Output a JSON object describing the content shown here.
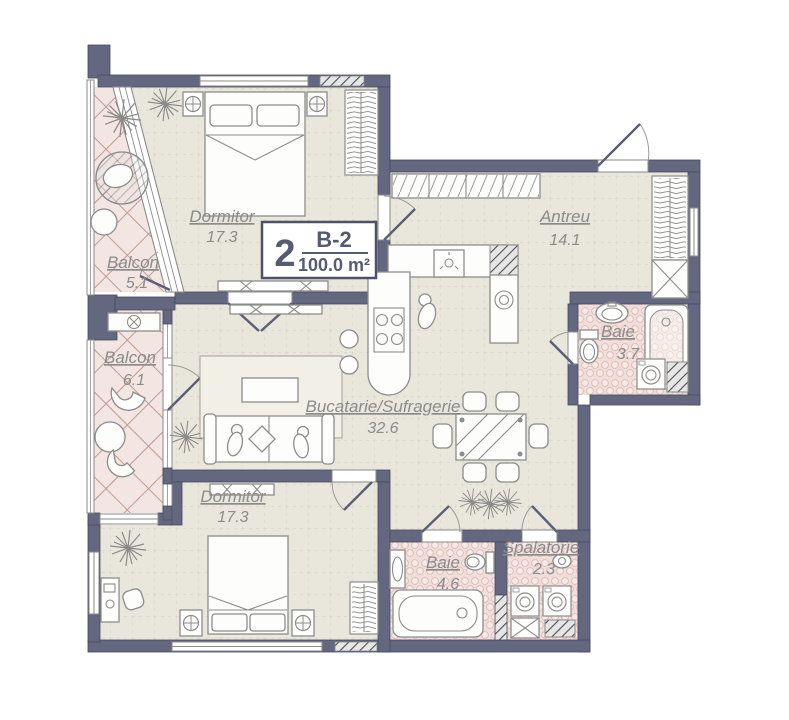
{
  "plan": {
    "title": "Apartment floor plan B-2",
    "unit_badge": {
      "rooms_count": "2",
      "unit_code": "B-2",
      "total_area": "100.0 m²"
    },
    "rooms": [
      {
        "id": "dormitor-top",
        "name": "Dormitor",
        "area": "17.3"
      },
      {
        "id": "antreu",
        "name": "Antreu",
        "area": "14.1"
      },
      {
        "id": "balcon-top",
        "name": "Balcon",
        "area": "5.1"
      },
      {
        "id": "balcon-mid",
        "name": "Balcon",
        "area": "6.1"
      },
      {
        "id": "baie-top",
        "name": "Baie",
        "area": "3.7"
      },
      {
        "id": "bucatarie-sufragerie",
        "name": "Bucatarie/Sufragerie",
        "area": "32.6"
      },
      {
        "id": "dormitor-bottom",
        "name": "Dormitor",
        "area": "17.3"
      },
      {
        "id": "baie-bottom",
        "name": "Baie",
        "area": "4.6"
      },
      {
        "id": "spalatorie",
        "name": "Spalatorie",
        "area": "2.3"
      }
    ],
    "colors": {
      "walls": "#636880",
      "floor_beige": "#e9e6dc",
      "floor_balcony": "#f3e5e1",
      "floor_bath": "#f1dedb",
      "tile_line": "#c19b93",
      "label_text": "#8b8b8b",
      "badge_text": "#565b72"
    }
  }
}
